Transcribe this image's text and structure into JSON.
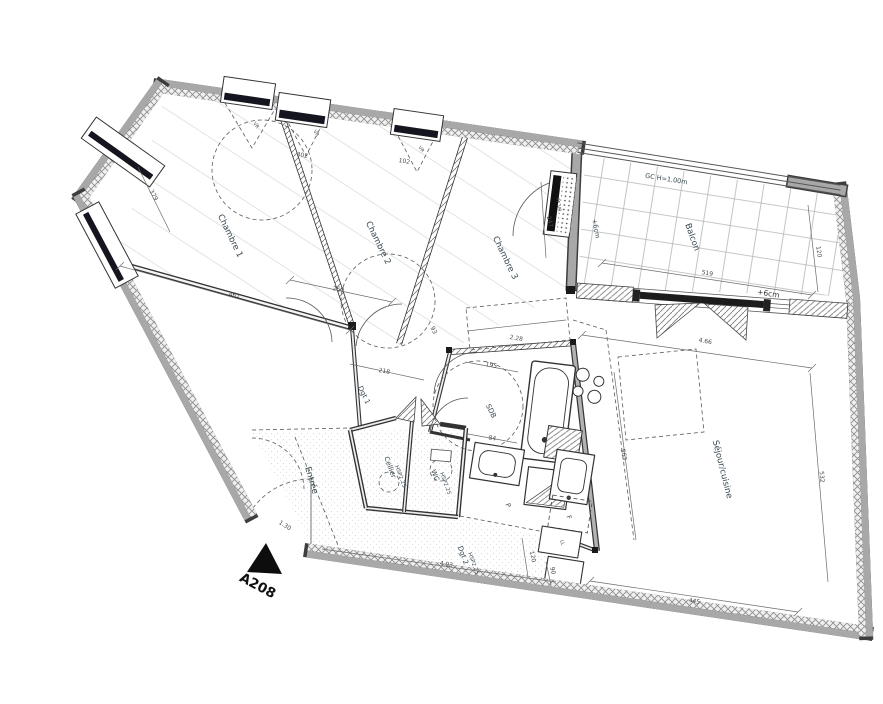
{
  "unit": {
    "label": "A208"
  },
  "rooms": [
    {
      "name": "chambre-1",
      "label": "Chambre 1"
    },
    {
      "name": "chambre-2",
      "label": "Chambre 2"
    },
    {
      "name": "chambre-3",
      "label": "Chambre 3"
    },
    {
      "name": "balcon",
      "label": "Balcon"
    },
    {
      "name": "sejour-cuisine",
      "label": "Séjour/cuisine"
    },
    {
      "name": "sdb",
      "label": "SDB"
    },
    {
      "name": "wc",
      "label": "WC",
      "height_note": "HSP2.25"
    },
    {
      "name": "cellier",
      "label": "Cellier",
      "height_note": "HSP2.25"
    },
    {
      "name": "entree",
      "label": "Entrée"
    },
    {
      "name": "dgt-1",
      "label": "Dgt 1"
    },
    {
      "name": "dgt-2",
      "label": "Dgt 2",
      "height_note": "HSP2.25"
    }
  ],
  "annotations": {
    "railing": "GC H=1.00m",
    "level_left": "+6cm",
    "level_right": "+6cm",
    "balcony_door": "PF VR",
    "shutter": "VR",
    "fridge": "F",
    "washer": "LL",
    "closet": "P"
  },
  "dimensions": {
    "ch1_width": "461",
    "left_wall": "379",
    "win1": "302",
    "win2": "102",
    "ch2_width": "260",
    "partition": "93",
    "corridor": "218",
    "ch3_closet": "2.28",
    "sdb_top": "195",
    "basin": "84",
    "balcony_door_h": "247",
    "balcony_width": "519",
    "balcony_depth": "120",
    "sejour_top": "4.66",
    "kitchen_length": "563",
    "right_wall": "532",
    "sejour_bottom": "445",
    "dgt2_length": "4.93",
    "entrance_door": "1.30",
    "kitchen_bottom_1": "120",
    "kitchen_bottom_2": "90"
  }
}
